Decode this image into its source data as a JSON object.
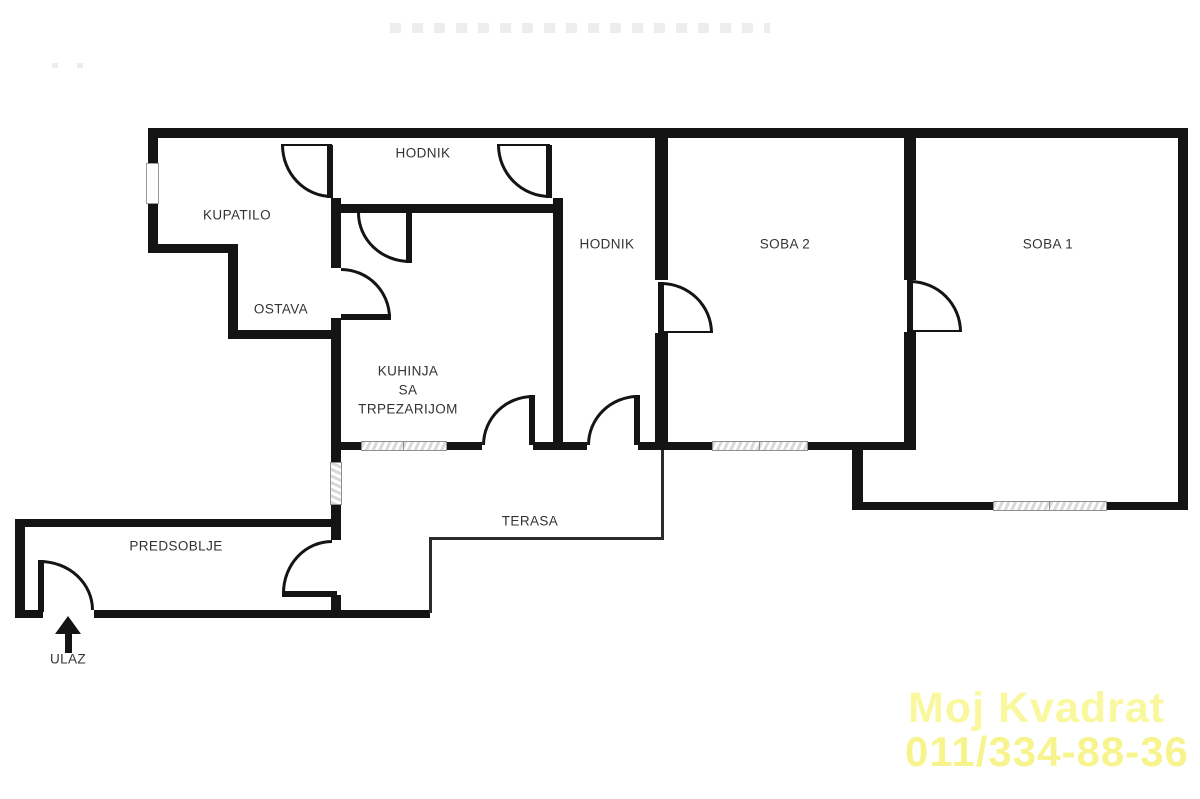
{
  "plan_title": "apartment floor plan",
  "rooms": {
    "kupatilo": "KUPATILO",
    "hodnik_upper": "HODNIK",
    "hodnik": "HODNIK",
    "ostava": "OSTAVA",
    "kuhinja_line1": "KUHINJA",
    "kuhinja_line2": "SA",
    "kuhinja_line3": "TRPEZARIJOM",
    "soba2": "SOBA 2",
    "soba1": "SOBA 1",
    "terasa": "TERASA",
    "predsoblje": "PREDSOBLJE",
    "ulaz": "ULAZ"
  },
  "watermark": {
    "line1": "Moj Kvadrat",
    "line2": "011/334-88-36",
    "color_line1": "#faf89e",
    "color_line2": "#f8f48d"
  },
  "colors": {
    "wall": "#141414",
    "label_text": "#333333",
    "thin_line": "#2b2b2b",
    "window_hatch": "#d9d9d9",
    "background": "#ffffff"
  }
}
